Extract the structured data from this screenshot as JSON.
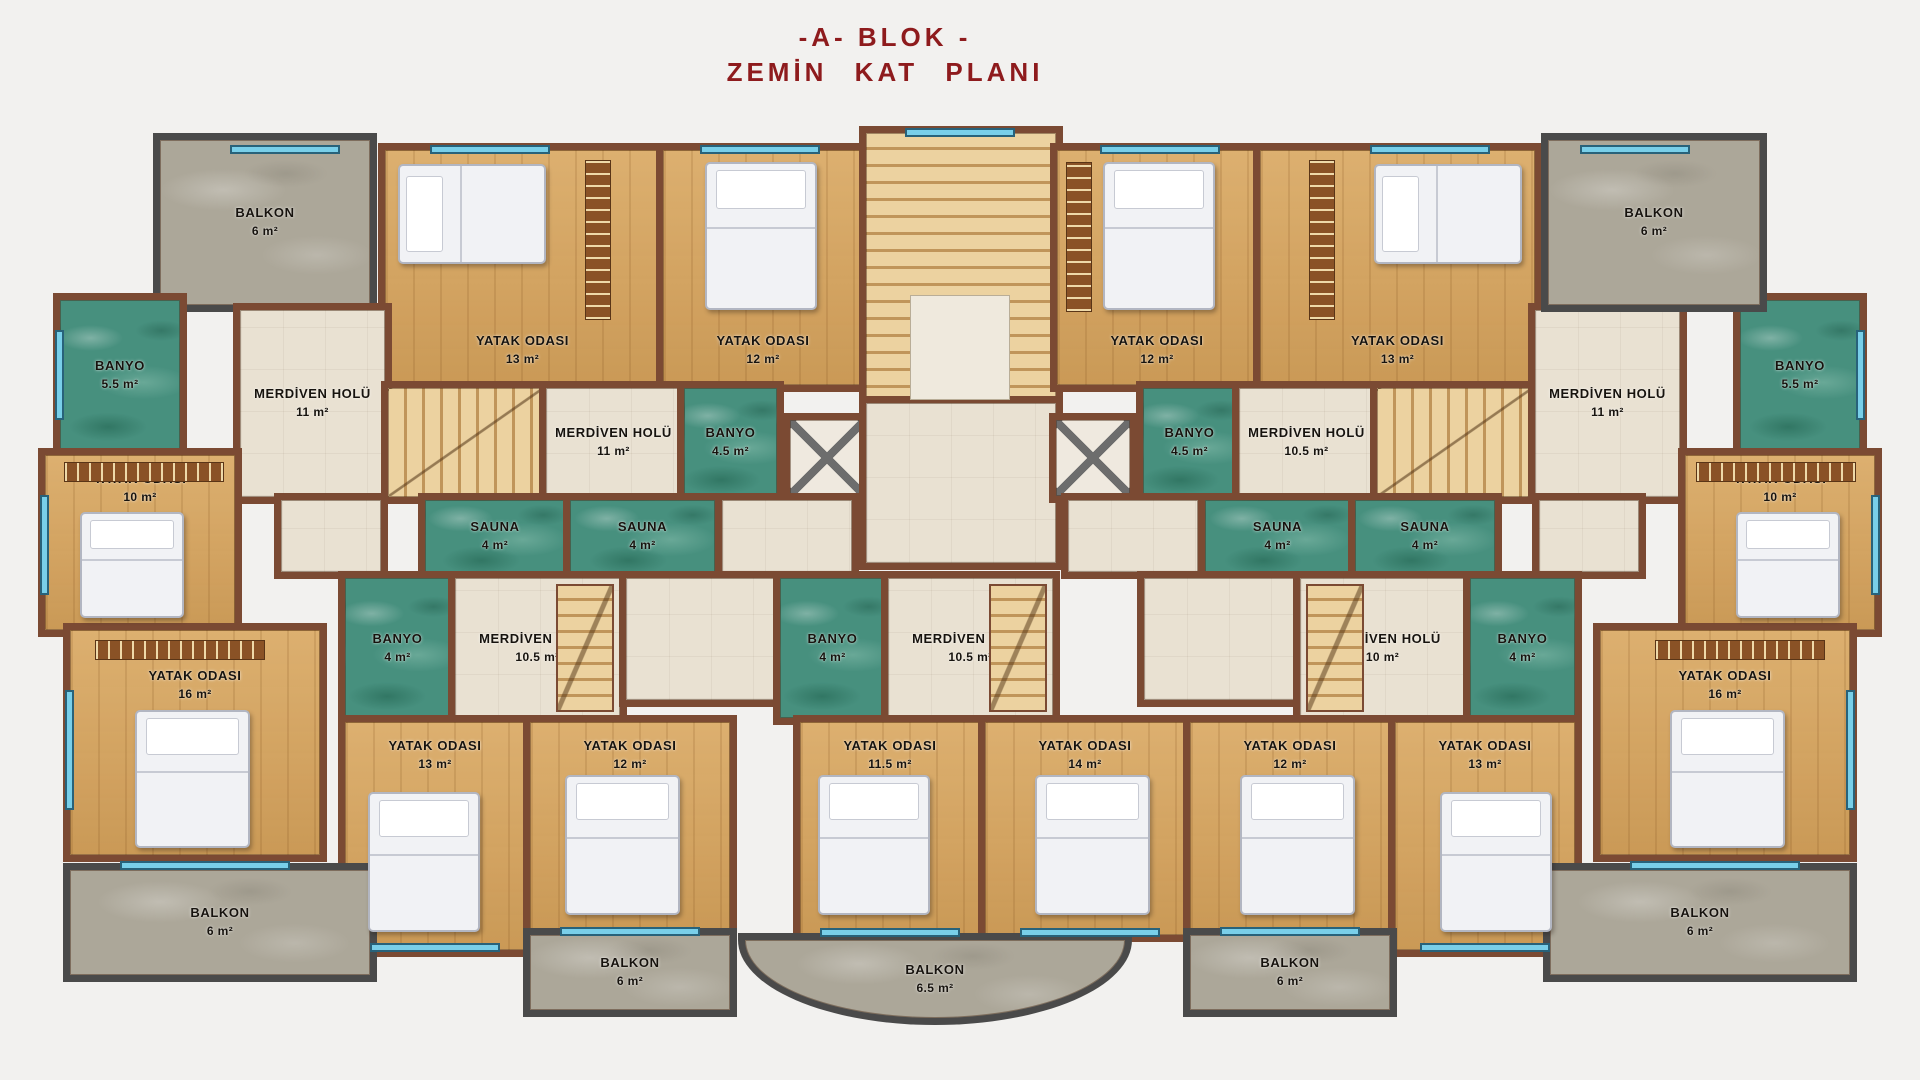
{
  "title": {
    "line1": "-A- BLOK -",
    "line2": "ZEMİN KAT PLANI",
    "color": "#8e1b1d"
  },
  "legend": {
    "room_types": [
      "bedroom",
      "stair-hall",
      "bathroom",
      "sauna",
      "balcony"
    ],
    "floor_colors": {
      "bedroom_wood": "#d7a55f",
      "hall_tile": "#e9e1d2",
      "bath_marble": "#47907e",
      "balcony_marble": "#aca799",
      "wall_brick": "#7b4a33",
      "window": "#79cfe9"
    }
  },
  "rooms": [
    {
      "id": "balkon-tl",
      "label": "BALKON",
      "area": "6 m²",
      "type": "balcony",
      "lp": "c",
      "rect": [
        160,
        140,
        210,
        165
      ]
    },
    {
      "id": "yatak13-tl",
      "label": "YATAK ODASI",
      "area": "13 m²",
      "type": "wood",
      "lp": "b",
      "rect": [
        385,
        150,
        275,
        235
      ]
    },
    {
      "id": "yatak12-tl",
      "label": "YATAK ODASI",
      "area": "12 m²",
      "type": "wood",
      "lp": "b",
      "rect": [
        663,
        150,
        200,
        235
      ]
    },
    {
      "id": "banyo55-l",
      "label": "BANYO",
      "area": "5.5 m²",
      "type": "bath",
      "lp": "c",
      "rect": [
        60,
        300,
        120,
        150
      ]
    },
    {
      "id": "merd11-far-l",
      "label": "MERDİVEN HOLÜ",
      "area": "11 m²",
      "type": "hall",
      "lp": "c",
      "rect": [
        240,
        310,
        145,
        187
      ]
    },
    {
      "id": "stair-l1",
      "label": "",
      "area": "",
      "type": "stair",
      "lp": "c",
      "rect": [
        388,
        388,
        155,
        109
      ]
    },
    {
      "id": "merd11-cl",
      "label": "MERDİVEN HOLÜ",
      "area": "11 m²",
      "type": "hall",
      "lp": "c",
      "rect": [
        546,
        388,
        135,
        109
      ]
    },
    {
      "id": "banyo45-l",
      "label": "BANYO",
      "area": "4.5 m²",
      "type": "bath",
      "lp": "c",
      "rect": [
        684,
        388,
        93,
        109
      ]
    },
    {
      "id": "shaft-l",
      "label": "",
      "area": "",
      "type": "shaft",
      "lp": "c",
      "rect": [
        790,
        420,
        74,
        76
      ]
    },
    {
      "id": "corridor-l1",
      "label": "",
      "area": "",
      "type": "corridor",
      "lp": "c",
      "rect": [
        722,
        500,
        130,
        72
      ]
    },
    {
      "id": "yatak10-l",
      "label": "YATAK ODASI",
      "area": "10 m²",
      "type": "wood",
      "lp": "t",
      "rect": [
        45,
        455,
        190,
        175
      ]
    },
    {
      "id": "corridor-l2",
      "label": "",
      "area": "",
      "type": "corridor",
      "lp": "c",
      "rect": [
        281,
        500,
        100,
        72
      ]
    },
    {
      "id": "sauna-l1",
      "label": "SAUNA",
      "area": "4 m²",
      "type": "bath",
      "lp": "c",
      "rect": [
        425,
        500,
        140,
        72
      ]
    },
    {
      "id": "sauna-l2",
      "label": "SAUNA",
      "area": "4 m²",
      "type": "bath",
      "lp": "c",
      "rect": [
        570,
        500,
        145,
        72
      ]
    },
    {
      "id": "stairwell-center",
      "label": "",
      "area": "",
      "type": "stair-c",
      "lp": "c",
      "rect": [
        866,
        133,
        190,
        270
      ]
    },
    {
      "id": "landing-center",
      "label": "",
      "area": "",
      "type": "corridor",
      "lp": "c",
      "rect": [
        866,
        403,
        190,
        160
      ]
    },
    {
      "id": "yatak12-tr",
      "label": "YATAK ODASI",
      "area": "12 m²",
      "type": "wood",
      "lp": "b",
      "rect": [
        1057,
        150,
        200,
        235
      ]
    },
    {
      "id": "yatak13-tr",
      "label": "YATAK ODASI",
      "area": "13 m²",
      "type": "wood",
      "lp": "b",
      "rect": [
        1260,
        150,
        275,
        235
      ]
    },
    {
      "id": "banyo45-r",
      "label": "BANYO",
      "area": "4.5 m²",
      "type": "bath",
      "lp": "c",
      "rect": [
        1143,
        388,
        93,
        109
      ]
    },
    {
      "id": "merd105-tr",
      "label": "MERDİVEN HOLÜ",
      "area": "10.5 m²",
      "type": "hall",
      "lp": "c",
      "rect": [
        1239,
        388,
        135,
        109
      ]
    },
    {
      "id": "stair-r1",
      "label": "",
      "area": "",
      "type": "stair",
      "lp": "c",
      "rect": [
        1377,
        388,
        155,
        109
      ]
    },
    {
      "id": "merd11-far-r",
      "label": "MERDİVEN HOLÜ",
      "area": "11 m²",
      "type": "hall",
      "lp": "c",
      "rect": [
        1535,
        310,
        145,
        187
      ]
    },
    {
      "id": "banyo55-r",
      "label": "BANYO",
      "area": "5.5 m²",
      "type": "bath",
      "lp": "c",
      "rect": [
        1740,
        300,
        120,
        150
      ]
    },
    {
      "id": "balkon-tr",
      "label": "BALKON",
      "area": "6 m²",
      "type": "balcony",
      "lp": "c",
      "rect": [
        1548,
        140,
        212,
        165
      ]
    },
    {
      "id": "shaft-r",
      "label": "",
      "area": "",
      "type": "shaft",
      "lp": "c",
      "rect": [
        1056,
        420,
        74,
        76
      ]
    },
    {
      "id": "corridor-r1",
      "label": "",
      "area": "",
      "type": "corridor",
      "lp": "c",
      "rect": [
        1068,
        500,
        130,
        72
      ]
    },
    {
      "id": "sauna-r2",
      "label": "SAUNA",
      "area": "4 m²",
      "type": "bath",
      "lp": "c",
      "rect": [
        1205,
        500,
        145,
        72
      ]
    },
    {
      "id": "sauna-r1",
      "label": "SAUNA",
      "area": "4 m²",
      "type": "bath",
      "lp": "c",
      "rect": [
        1355,
        500,
        140,
        72
      ]
    },
    {
      "id": "corridor-r2",
      "label": "",
      "area": "",
      "type": "corridor",
      "lp": "c",
      "rect": [
        1539,
        500,
        100,
        72
      ]
    },
    {
      "id": "yatak10-r",
      "label": "YATAK ODASI",
      "area": "10 m²",
      "type": "wood",
      "lp": "t",
      "rect": [
        1685,
        455,
        190,
        175
      ]
    },
    {
      "id": "banyo4-l",
      "label": "BANYO",
      "area": "4 m²",
      "type": "bath",
      "lp": "c",
      "rect": [
        345,
        578,
        105,
        140
      ]
    },
    {
      "id": "merd105-l",
      "label": "MERDİVEN HOLÜ",
      "area": "10.5 m²",
      "type": "hall",
      "lp": "c",
      "rect": [
        455,
        578,
        165,
        140
      ]
    },
    {
      "id": "corridor-l3",
      "label": "",
      "area": "",
      "type": "corridor",
      "lp": "c",
      "rect": [
        626,
        578,
        150,
        122
      ]
    },
    {
      "id": "banyo4-c",
      "label": "BANYO",
      "area": "4 m²",
      "type": "bath",
      "lp": "c",
      "rect": [
        780,
        578,
        105,
        140
      ]
    },
    {
      "id": "merd105-c",
      "label": "MERDİVEN HOLÜ",
      "area": "10.5 m²",
      "type": "hall",
      "lp": "c",
      "rect": [
        888,
        578,
        165,
        140
      ]
    },
    {
      "id": "corridor-r3",
      "label": "",
      "area": "",
      "type": "corridor",
      "lp": "c",
      "rect": [
        1144,
        578,
        150,
        122
      ]
    },
    {
      "id": "merd10-r",
      "label": "MERDİVEN HOLÜ",
      "area": "10 m²",
      "type": "hall",
      "lp": "c",
      "rect": [
        1300,
        578,
        165,
        140
      ]
    },
    {
      "id": "banyo4-r",
      "label": "BANYO",
      "area": "4 m²",
      "type": "bath",
      "lp": "c",
      "rect": [
        1470,
        578,
        105,
        140
      ]
    },
    {
      "id": "yatak16-l",
      "label": "YATAK ODASI",
      "area": "16 m²",
      "type": "wood",
      "lp": "t2",
      "rect": [
        70,
        630,
        250,
        225
      ]
    },
    {
      "id": "yatak13-bl",
      "label": "YATAK ODASI",
      "area": "13 m²",
      "type": "wood",
      "lp": "t",
      "rect": [
        345,
        722,
        180,
        228
      ]
    },
    {
      "id": "yatak12-bl",
      "label": "YATAK ODASI",
      "area": "12 m²",
      "type": "wood",
      "lp": "t",
      "rect": [
        530,
        722,
        200,
        208
      ]
    },
    {
      "id": "yatak115-c",
      "label": "YATAK ODASI",
      "area": "11.5 m²",
      "type": "wood",
      "lp": "t",
      "rect": [
        800,
        722,
        180,
        213
      ]
    },
    {
      "id": "yatak14-c",
      "label": "YATAK ODASI",
      "area": "14 m²",
      "type": "wood",
      "lp": "t",
      "rect": [
        985,
        722,
        200,
        213
      ]
    },
    {
      "id": "yatak12-br",
      "label": "YATAK ODASI",
      "area": "12 m²",
      "type": "wood",
      "lp": "t",
      "rect": [
        1190,
        722,
        200,
        208
      ]
    },
    {
      "id": "yatak13-br",
      "label": "YATAK ODASI",
      "area": "13 m²",
      "type": "wood",
      "lp": "t",
      "rect": [
        1395,
        722,
        180,
        228
      ]
    },
    {
      "id": "yatak16-r",
      "label": "YATAK ODASI",
      "area": "16 m²",
      "type": "wood",
      "lp": "t2",
      "rect": [
        1600,
        630,
        250,
        225
      ]
    },
    {
      "id": "balkon-bl",
      "label": "BALKON",
      "area": "6 m²",
      "type": "balcony",
      "lp": "c",
      "rect": [
        70,
        870,
        300,
        105
      ]
    },
    {
      "id": "balkon-blc",
      "label": "BALKON",
      "area": "6 m²",
      "type": "balcony",
      "lp": "c",
      "rect": [
        530,
        935,
        200,
        75
      ]
    },
    {
      "id": "balkon-c",
      "label": "BALKON",
      "area": "6.5 m²",
      "type": "balcony-curved",
      "lp": "c",
      "rect": [
        745,
        940,
        380,
        78
      ]
    },
    {
      "id": "balkon-brc",
      "label": "BALKON",
      "area": "6 m²",
      "type": "balcony",
      "lp": "c",
      "rect": [
        1190,
        935,
        200,
        75
      ]
    },
    {
      "id": "balkon-br",
      "label": "BALKON",
      "area": "6 m²",
      "type": "balcony",
      "lp": "c",
      "rect": [
        1550,
        870,
        300,
        105
      ]
    }
  ],
  "decor": [
    {
      "kind": "bed-h",
      "name": "bed",
      "rect": [
        398,
        164,
        148,
        100
      ]
    },
    {
      "kind": "bed-v",
      "name": "bed",
      "rect": [
        705,
        162,
        112,
        148
      ]
    },
    {
      "kind": "bed-v",
      "name": "bed",
      "rect": [
        1103,
        162,
        112,
        148
      ]
    },
    {
      "kind": "bed-h",
      "name": "bed",
      "rect": [
        1374,
        164,
        148,
        100
      ]
    },
    {
      "kind": "bed-v",
      "name": "bed",
      "rect": [
        80,
        512,
        104,
        106
      ]
    },
    {
      "kind": "bed-v",
      "name": "bed",
      "rect": [
        1736,
        512,
        104,
        106
      ]
    },
    {
      "kind": "bed-v",
      "name": "bed",
      "rect": [
        135,
        710,
        115,
        138
      ]
    },
    {
      "kind": "bed-v",
      "name": "bed",
      "rect": [
        1670,
        710,
        115,
        138
      ]
    },
    {
      "kind": "bed-v",
      "name": "bed",
      "rect": [
        368,
        792,
        112,
        140
      ]
    },
    {
      "kind": "bed-v",
      "name": "bed",
      "rect": [
        565,
        775,
        115,
        140
      ]
    },
    {
      "kind": "bed-v",
      "name": "bed",
      "rect": [
        818,
        775,
        112,
        140
      ]
    },
    {
      "kind": "bed-v",
      "name": "bed",
      "rect": [
        1035,
        775,
        115,
        140
      ]
    },
    {
      "kind": "bed-v",
      "name": "bed",
      "rect": [
        1240,
        775,
        115,
        140
      ]
    },
    {
      "kind": "bed-v",
      "name": "bed",
      "rect": [
        1440,
        792,
        112,
        140
      ]
    },
    {
      "kind": "ward-v",
      "name": "wardrobe",
      "rect": [
        585,
        160,
        26,
        160
      ]
    },
    {
      "kind": "ward-v",
      "name": "wardrobe",
      "rect": [
        1309,
        160,
        26,
        160
      ]
    },
    {
      "kind": "ward-v",
      "name": "wardrobe",
      "rect": [
        1066,
        162,
        26,
        150
      ]
    },
    {
      "kind": "ward-h",
      "name": "wardrobe",
      "rect": [
        64,
        462,
        160,
        20
      ]
    },
    {
      "kind": "ward-h",
      "name": "wardrobe",
      "rect": [
        1696,
        462,
        160,
        20
      ]
    },
    {
      "kind": "ward-h",
      "name": "wardrobe",
      "rect": [
        95,
        640,
        170,
        20
      ]
    },
    {
      "kind": "ward-h",
      "name": "wardrobe",
      "rect": [
        1655,
        640,
        170,
        20
      ]
    },
    {
      "kind": "stair-v",
      "name": "stairs",
      "rect": [
        556,
        584,
        58,
        128
      ]
    },
    {
      "kind": "stair-v",
      "name": "stairs",
      "rect": [
        989,
        584,
        58,
        128
      ]
    },
    {
      "kind": "stair-v",
      "name": "stairs",
      "rect": [
        1306,
        584,
        58,
        128
      ]
    },
    {
      "kind": "landing",
      "name": "stair-landing",
      "rect": [
        910,
        295,
        100,
        105
      ]
    },
    {
      "kind": "win-h",
      "name": "window",
      "rect": [
        430,
        145,
        120,
        9
      ]
    },
    {
      "kind": "win-h",
      "name": "window",
      "rect": [
        700,
        145,
        120,
        9
      ]
    },
    {
      "kind": "win-h",
      "name": "window",
      "rect": [
        1100,
        145,
        120,
        9
      ]
    },
    {
      "kind": "win-h",
      "name": "window",
      "rect": [
        1370,
        145,
        120,
        9
      ]
    },
    {
      "kind": "win-h",
      "name": "window",
      "rect": [
        230,
        145,
        110,
        9
      ]
    },
    {
      "kind": "win-h",
      "name": "window",
      "rect": [
        1580,
        145,
        110,
        9
      ]
    },
    {
      "kind": "win-h",
      "name": "window",
      "rect": [
        905,
        128,
        110,
        9
      ]
    },
    {
      "kind": "win-v",
      "name": "window",
      "rect": [
        55,
        330,
        9,
        90
      ]
    },
    {
      "kind": "win-v",
      "name": "window",
      "rect": [
        40,
        495,
        9,
        100
      ]
    },
    {
      "kind": "win-v",
      "name": "window",
      "rect": [
        65,
        690,
        9,
        120
      ]
    },
    {
      "kind": "win-v",
      "name": "window",
      "rect": [
        1856,
        330,
        9,
        90
      ]
    },
    {
      "kind": "win-v",
      "name": "window",
      "rect": [
        1871,
        495,
        9,
        100
      ]
    },
    {
      "kind": "win-v",
      "name": "window",
      "rect": [
        1846,
        690,
        9,
        120
      ]
    },
    {
      "kind": "win-h",
      "name": "window",
      "rect": [
        120,
        861,
        170,
        9
      ]
    },
    {
      "kind": "win-h",
      "name": "window",
      "rect": [
        370,
        943,
        130,
        9
      ]
    },
    {
      "kind": "win-h",
      "name": "window",
      "rect": [
        560,
        927,
        140,
        9
      ]
    },
    {
      "kind": "win-h",
      "name": "window",
      "rect": [
        820,
        928,
        140,
        9
      ]
    },
    {
      "kind": "win-h",
      "name": "window",
      "rect": [
        1020,
        928,
        140,
        9
      ]
    },
    {
      "kind": "win-h",
      "name": "window",
      "rect": [
        1220,
        927,
        140,
        9
      ]
    },
    {
      "kind": "win-h",
      "name": "window",
      "rect": [
        1420,
        943,
        130,
        9
      ]
    },
    {
      "kind": "win-h",
      "name": "window",
      "rect": [
        1630,
        861,
        170,
        9
      ]
    }
  ]
}
